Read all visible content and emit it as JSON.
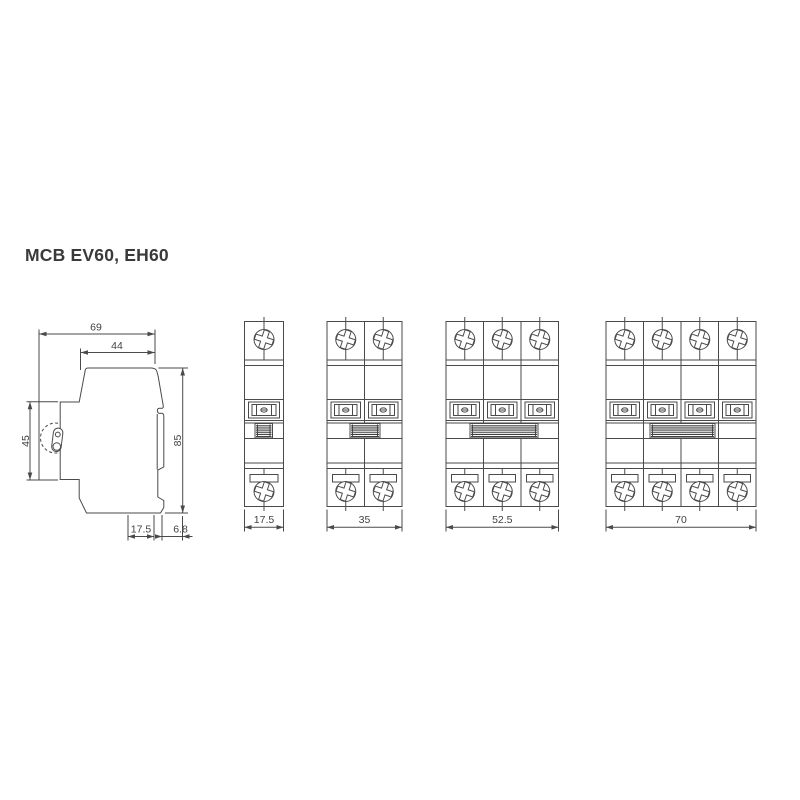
{
  "page": {
    "title": "MCB EV60, EH60",
    "background_color": "#ffffff",
    "line_color": "#4a4a4a",
    "text_color": "#424242"
  },
  "side_view": {
    "description": "side-profile-drawing",
    "dims": {
      "overall_depth": "69",
      "front_depth": "44",
      "front_height": "45",
      "overall_height": "85",
      "bottom_width": "17.5",
      "rail_offset": "6.8"
    }
  },
  "front_views": [
    {
      "id": "1-pole",
      "poles": 1,
      "width": "17.5"
    },
    {
      "id": "2-pole",
      "poles": 2,
      "width": "35"
    },
    {
      "id": "3-pole",
      "poles": 3,
      "width": "52.5"
    },
    {
      "id": "4-pole",
      "poles": 4,
      "width": "70"
    }
  ]
}
